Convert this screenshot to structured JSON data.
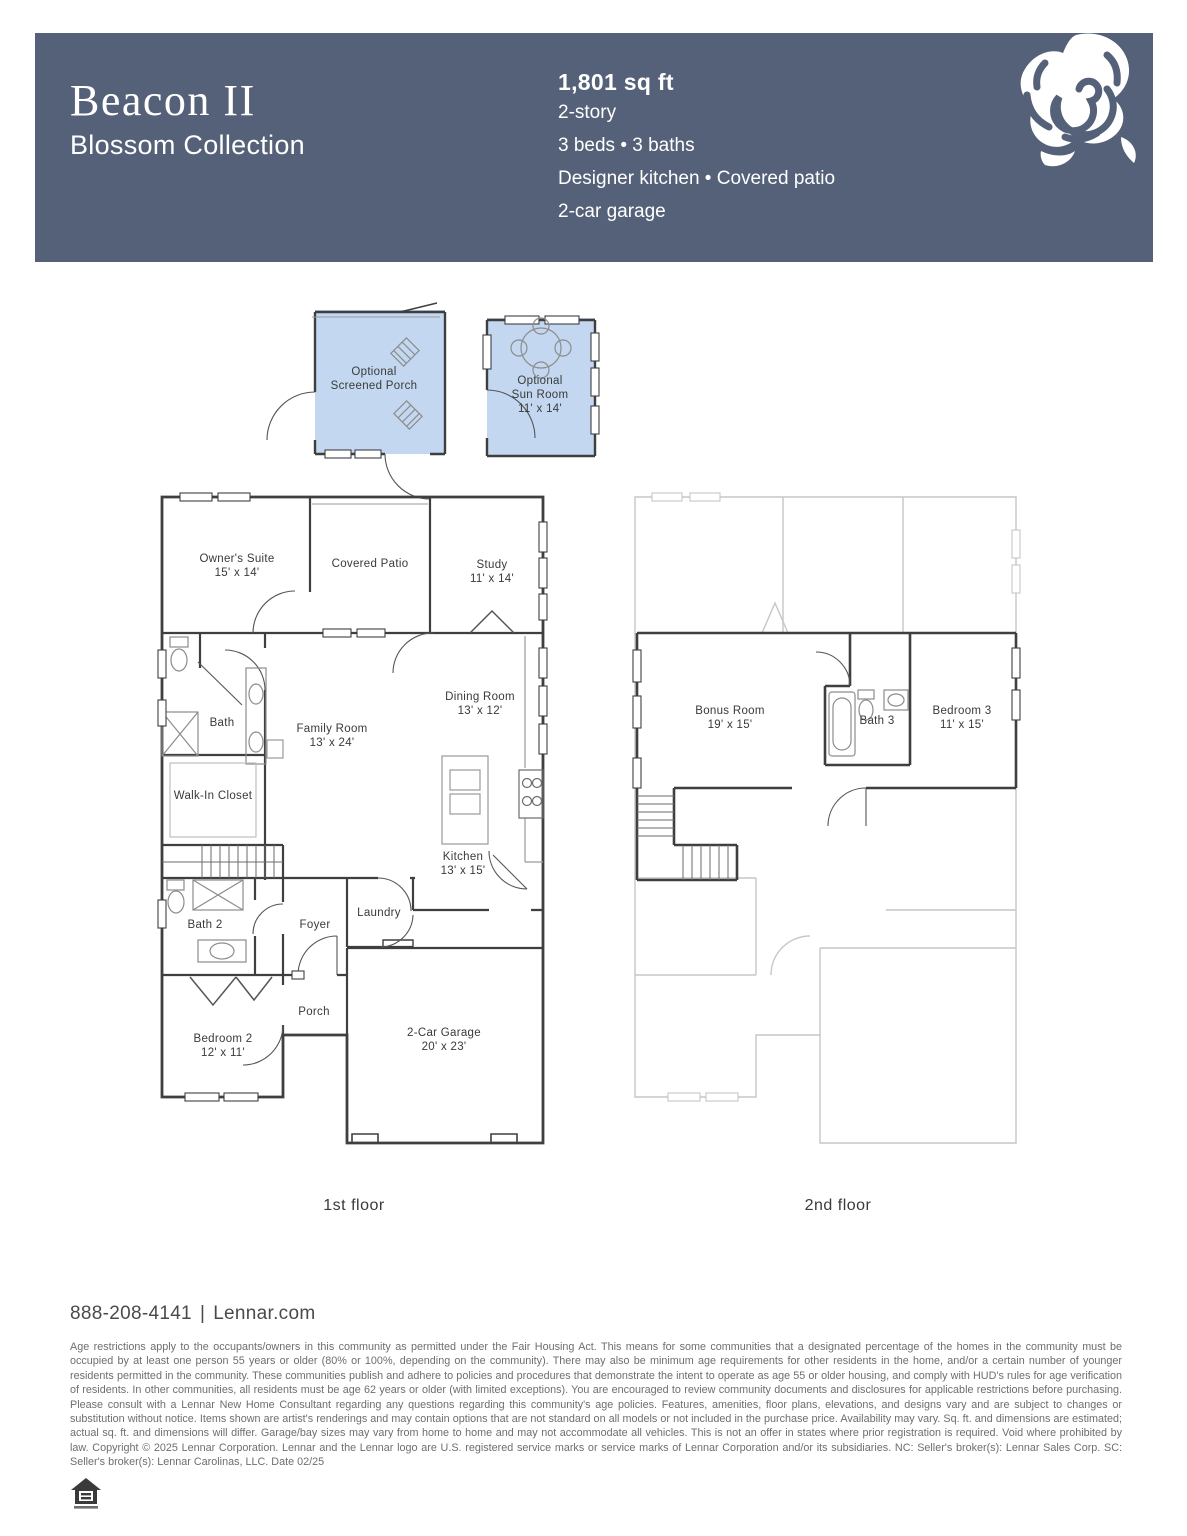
{
  "header": {
    "title": "Beacon II",
    "subtitle": "Blossom Collection",
    "sqft": "1,801 sq ft",
    "specs": [
      "2-story",
      "3 beds • 3 baths",
      "Designer kitchen • Covered patio",
      "2-car garage"
    ],
    "logo_icon": "rose-icon"
  },
  "options": {
    "screened_porch": {
      "line1": "Optional",
      "line2": "Screened Porch"
    },
    "sun_room": {
      "line1": "Optional",
      "line2": "Sun Room",
      "dims": "11' x 14'"
    }
  },
  "floor1": {
    "label": "1st floor",
    "rooms": {
      "owners_suite": {
        "name": "Owner's Suite",
        "dims": "15' x 14'"
      },
      "covered_patio": {
        "name": "Covered Patio"
      },
      "study": {
        "name": "Study",
        "dims": "11' x 14'"
      },
      "bath": {
        "name": "Bath"
      },
      "family_room": {
        "name": "Family Room",
        "dims": "13' x 24'"
      },
      "dining_room": {
        "name": "Dining Room",
        "dims": "13' x 12'"
      },
      "walk_in_closet": {
        "name": "Walk-In Closet"
      },
      "kitchen": {
        "name": "Kitchen",
        "dims": "13' x 15'"
      },
      "bath_2": {
        "name": "Bath 2"
      },
      "foyer": {
        "name": "Foyer"
      },
      "laundry": {
        "name": "Laundry"
      },
      "porch": {
        "name": "Porch"
      },
      "bedroom_2": {
        "name": "Bedroom 2",
        "dims": "12' x 11'"
      },
      "garage": {
        "name": "2-Car Garage",
        "dims": "20' x 23'"
      }
    }
  },
  "floor2": {
    "label": "2nd floor",
    "rooms": {
      "bonus_room": {
        "name": "Bonus Room",
        "dims": "19' x 15'"
      },
      "bath_3": {
        "name": "Bath 3"
      },
      "bedroom_3": {
        "name": "Bedroom 3",
        "dims": "11' x 15'"
      }
    }
  },
  "footer": {
    "phone": "888-208-4141",
    "separator": "|",
    "website": "Lennar.com",
    "equal_housing_icon": "equal-housing-icon",
    "legal": "Age restrictions apply to the occupants/owners in this community as permitted under the Fair Housing Act. This means for some communities that a designated percentage of the homes in the community must be occupied by at least one person 55 years or older (80% or 100%, depending on the community). There may also be minimum age requirements for other residents in the home, and/or a certain number of younger residents permitted in the community. These communities publish and adhere to policies and procedures that demonstrate the intent to operate as age 55 or older housing, and comply with HUD's rules for age verification of residents. In other communities, all residents must be age 62 years or older (with limited exceptions). You are encouraged to review community documents and disclosures for applicable restrictions before purchasing. Please consult with a Lennar New Home Consultant regarding any questions regarding this community's age policies. Features, amenities, floor plans, elevations, and designs vary and are subject to changes or substitution without notice. Items shown are artist's renderings and may contain options that are not standard on all models or not included in the purchase price. Availability may vary. Sq. ft. and dimensions are estimated; actual sq. ft. and dimensions will differ. Garage/bay sizes may vary from home to home and may not accommodate all vehicles. This is not an offer in states where prior registration is required. Void where prohibited by law. Copyright © 2025 Lennar Corporation. Lennar and the Lennar logo are U.S. registered service marks or service marks of Lennar Corporation and/or its subsidiaries. NC: Seller's broker(s): Lennar Sales Corp. SC: Seller's broker(s): Lennar Carolinas, LLC. Date 02/25"
  },
  "colors": {
    "header_band": "#556178",
    "option_room_fill": "#C3D8F0",
    "wall_dark": "#3F3F3F",
    "ghost_gray": "#C6C6C6",
    "label_text": "#3A3A3A"
  }
}
